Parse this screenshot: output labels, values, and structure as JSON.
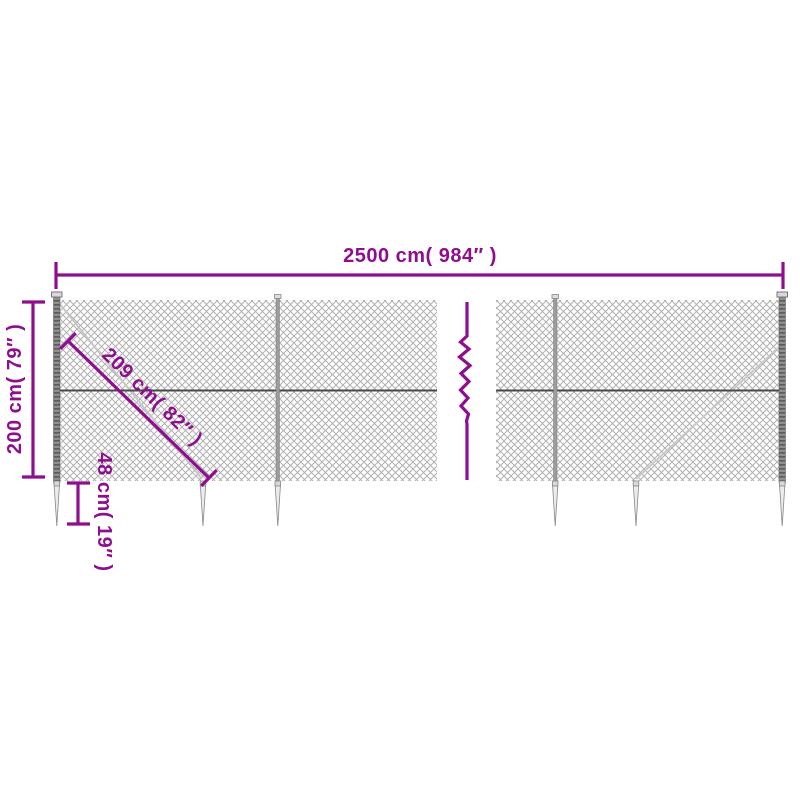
{
  "diagram": {
    "title": "chain-link fence with ground spike anchors - dimension drawing",
    "labels": {
      "total_width": "2500 cm( 984″ )",
      "height": "200 cm( 79″ )",
      "diagonal_brace": "209 cm( 82″ )",
      "anchor_depth": "48 cm( 19″ )"
    },
    "colors": {
      "dimension_accent": "#8E0E8E",
      "mesh": "#B0B0B0",
      "tension_wire": "#4A4A4A",
      "post": "#8F8F8F",
      "spike_fill": "#ECECEC",
      "background": "#FFFFFF"
    }
  }
}
